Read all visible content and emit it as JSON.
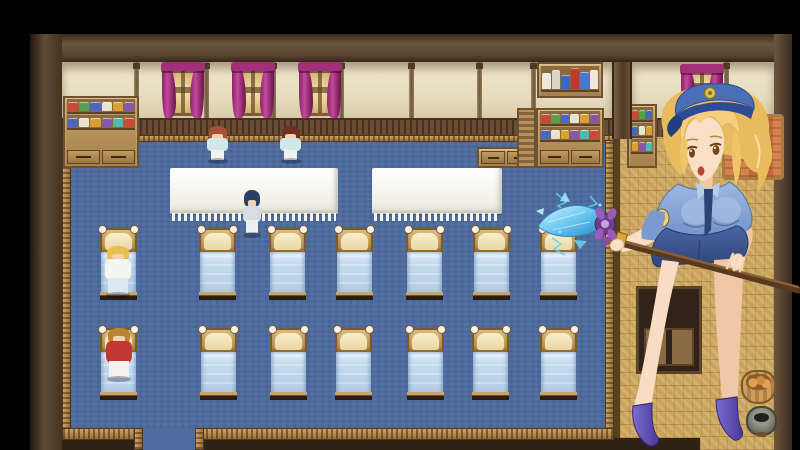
{
  "app": {
    "type": "rpg-game-screenshot",
    "scene": "infirmary-dormitory-room",
    "visible_text": ""
  },
  "palette": {
    "letterbox_black": "#000000",
    "wall_frame_brown": "#5e4a36",
    "wall_panel_cream": "#e9e0c5",
    "wainscot_brown": "#6a4b34",
    "carpet_blue": "#4d6b9e",
    "carpet_trim_gold": "#b58c54",
    "curtain_magenta": "#b03a8c",
    "window_glow": "#f2d9a2",
    "shelf_wood": "#b5915c",
    "table_white": "#f6f5ef",
    "bed_frame_tan": "#caa46a",
    "bed_blanket_blue": "#c3d9ed",
    "tatami_tan": "#c9a45e",
    "portrait_hair_blonde": "#e9bb5f",
    "portrait_cap_blue": "#4c6eb6",
    "portrait_shirt_blue": "#87a4d6",
    "portrait_skirt_navy": "#3c5694",
    "portrait_skin": "#f9dfc6",
    "portrait_heels_purple": "#5a4ab0",
    "spear_ice_blue": "#6cc8f0",
    "spear_guard_purple": "#6e3e8c",
    "staff_wood_brown": "#57391f"
  },
  "map": {
    "wall_seams_x": [
      134,
      204,
      271,
      339,
      409,
      477,
      531,
      724
    ],
    "windows": [
      {
        "name": "window-curtain-1",
        "x": 165,
        "y": 64,
        "w": 36,
        "h": 52
      },
      {
        "name": "window-curtain-2",
        "x": 235,
        "y": 64,
        "w": 36,
        "h": 52
      },
      {
        "name": "window-curtain-3",
        "x": 302,
        "y": 64,
        "w": 36,
        "h": 52
      },
      {
        "name": "window-curtain-right-room",
        "x": 684,
        "y": 66,
        "w": 36,
        "h": 38
      }
    ],
    "tables": [
      {
        "name": "white-table-left",
        "x": 170,
        "y": 168,
        "w": 168,
        "h": 46
      },
      {
        "name": "white-table-right",
        "x": 372,
        "y": 168,
        "w": 130,
        "h": 46
      }
    ],
    "bed_width": 37,
    "bed_rows": [
      {
        "y": 228,
        "h": 72,
        "xs": [
          100,
          199,
          269,
          336,
          406,
          473,
          540
        ]
      },
      {
        "y": 328,
        "h": 72,
        "xs": [
          100,
          200,
          270,
          335,
          407,
          472,
          540
        ]
      }
    ],
    "shelves": [
      {
        "name": "left-apothecary-shelf",
        "x": 63,
        "y": 96,
        "w": 76,
        "h": 72,
        "rows": 2,
        "drawers": true
      },
      {
        "name": "counter-cabinet",
        "x": 477,
        "y": 147,
        "w": 58,
        "h": 21,
        "rows": 0,
        "drawers": true
      },
      {
        "name": "bottle-shelf",
        "x": 537,
        "y": 62,
        "w": 66,
        "h": 36,
        "bottles": true
      },
      {
        "name": "medicine-cabinet",
        "x": 536,
        "y": 108,
        "w": 68,
        "h": 60,
        "rows": 2,
        "drawers": true
      },
      {
        "name": "louver-panel",
        "x": 517,
        "y": 108,
        "w": 19,
        "h": 60,
        "louver": true
      },
      {
        "name": "right-room-shelf",
        "x": 627,
        "y": 104,
        "w": 30,
        "h": 64,
        "rows": 3
      }
    ],
    "jar_colors": [
      "#cc4838",
      "#58a050",
      "#4868c0",
      "#e8e2d2",
      "#d8a030",
      "#8858a8",
      "#50b8b0"
    ],
    "bottle_colors": [
      "#ece8da",
      "#d8d4c6",
      "#3a68c0",
      "#c03828",
      "#4a78c8",
      "#ece8da"
    ],
    "bottle_heights": [
      68,
      80,
      58,
      92,
      72,
      84
    ],
    "sprites": [
      {
        "name": "nurse-standing-left",
        "kind": "stand",
        "x": 205,
        "y": 126,
        "w": 25,
        "h": 36,
        "hair": "#a8503a",
        "body": "#cfe8e8",
        "legs": "#f2f2ee"
      },
      {
        "name": "nurse-standing-right",
        "kind": "stand",
        "x": 278,
        "y": 126,
        "w": 25,
        "h": 36,
        "hair": "#6e3026",
        "body": "#cfe8e8",
        "legs": "#f2f2ee"
      },
      {
        "name": "attendant-blue-hair",
        "kind": "stand",
        "x": 241,
        "y": 190,
        "w": 22,
        "h": 46,
        "hair": "#2e3f66",
        "body": "#d8dde2",
        "legs": "#eceef0"
      },
      {
        "name": "patient-blonde-in-bed",
        "kind": "lie",
        "x": 103,
        "y": 246,
        "w": 30,
        "h": 50,
        "hair": "#e8c050",
        "body": "#f4f4f0",
        "legs": "#dce8f2"
      },
      {
        "name": "patient-red-in-bed",
        "kind": "lie",
        "x": 104,
        "y": 328,
        "w": 30,
        "h": 52,
        "hair": "#b8862e",
        "body": "#c23830",
        "legs": "#f2f2ee"
      }
    ],
    "props": [
      {
        "kind": "pillar",
        "name": "wall-pillar",
        "x": 612,
        "y": 62,
        "w": 20,
        "h": 77
      },
      {
        "kind": "bed-orange",
        "name": "orange-blanket-bed",
        "x": 722,
        "y": 114,
        "w": 62,
        "h": 66
      },
      {
        "kind": "back-door",
        "name": "wooden-cabinet-door",
        "x": 636,
        "y": 286,
        "w": 66,
        "h": 88
      },
      {
        "kind": "basket",
        "name": "bread-basket",
        "x": 741,
        "y": 370,
        "w": 35,
        "h": 34
      },
      {
        "kind": "pot",
        "name": "mortar-pot",
        "x": 746,
        "y": 406,
        "w": 31,
        "h": 30
      }
    ]
  },
  "portrait": {
    "name": "policewoman-with-ice-spear",
    "description": "blonde woman in blue police cap, shirt and skirt, purple heels, holding wooden staff with ice crystal spearhead"
  }
}
